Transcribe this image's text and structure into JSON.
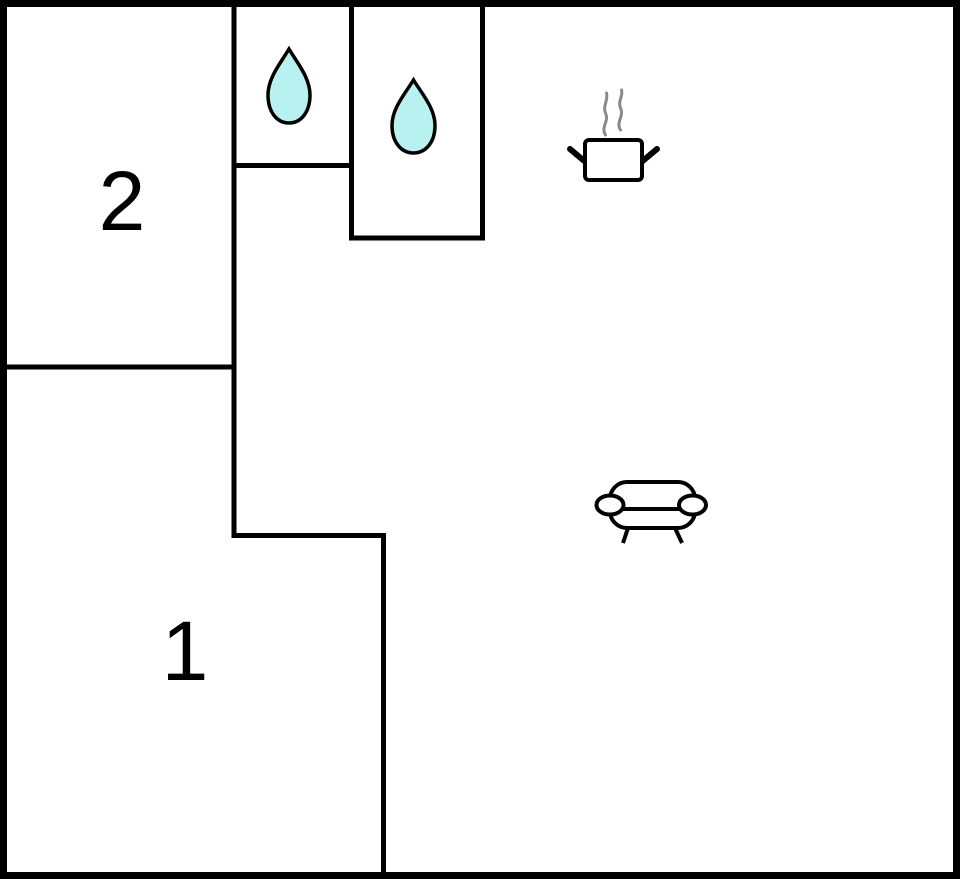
{
  "canvas": {
    "width": 960,
    "height": 879
  },
  "colors": {
    "wall": "#000000",
    "background": "#ffffff",
    "water_drop_fill": "#b8f1f0",
    "steam": "#8a8a8a",
    "furniture_fill": "#ffffff"
  },
  "outer_wall": {
    "x": 3.5,
    "y": 3.5,
    "width": 953,
    "height": 872,
    "thickness": 7
  },
  "inner_wall_thickness": 5,
  "walls": [
    {
      "name": "wall-room2-right",
      "x1": 234,
      "y1": 0,
      "x2": 234,
      "y2": 537
    },
    {
      "name": "wall-bath1-bottom",
      "x1": 231.5,
      "y1": 165.5,
      "x2": 354,
      "y2": 165.5
    },
    {
      "name": "wall-bath-divider",
      "x1": 351.5,
      "y1": 0,
      "x2": 351.5,
      "y2": 240
    },
    {
      "name": "wall-bath2-bottom",
      "x1": 349,
      "y1": 238,
      "x2": 485,
      "y2": 238
    },
    {
      "name": "wall-bath2-right",
      "x1": 482.5,
      "y1": 0,
      "x2": 482.5,
      "y2": 240.5
    },
    {
      "name": "wall-room2-bottom",
      "x1": 0,
      "y1": 367,
      "x2": 236.5,
      "y2": 367
    },
    {
      "name": "wall-room1-top-step",
      "x1": 231.5,
      "y1": 535.5,
      "x2": 386,
      "y2": 535.5
    },
    {
      "name": "wall-room1-right",
      "x1": 383.5,
      "y1": 533,
      "x2": 383.5,
      "y2": 879
    }
  ],
  "rooms": [
    {
      "label": "2",
      "cx": 122,
      "cy": 200
    },
    {
      "label": "1",
      "cx": 185,
      "cy": 650
    }
  ],
  "icons": [
    {
      "name": "water-drop-icon",
      "room": "bath-1",
      "cx": 289,
      "cy": 86
    },
    {
      "name": "water-drop-icon",
      "room": "bath-2",
      "cx": 413.5,
      "cy": 116.5
    },
    {
      "name": "steaming-pot-icon",
      "room": "kitchen-area",
      "cx": 613.5,
      "cy": 160
    },
    {
      "name": "sofa-icon",
      "room": "living-area",
      "cx": 652,
      "cy": 511
    }
  ]
}
